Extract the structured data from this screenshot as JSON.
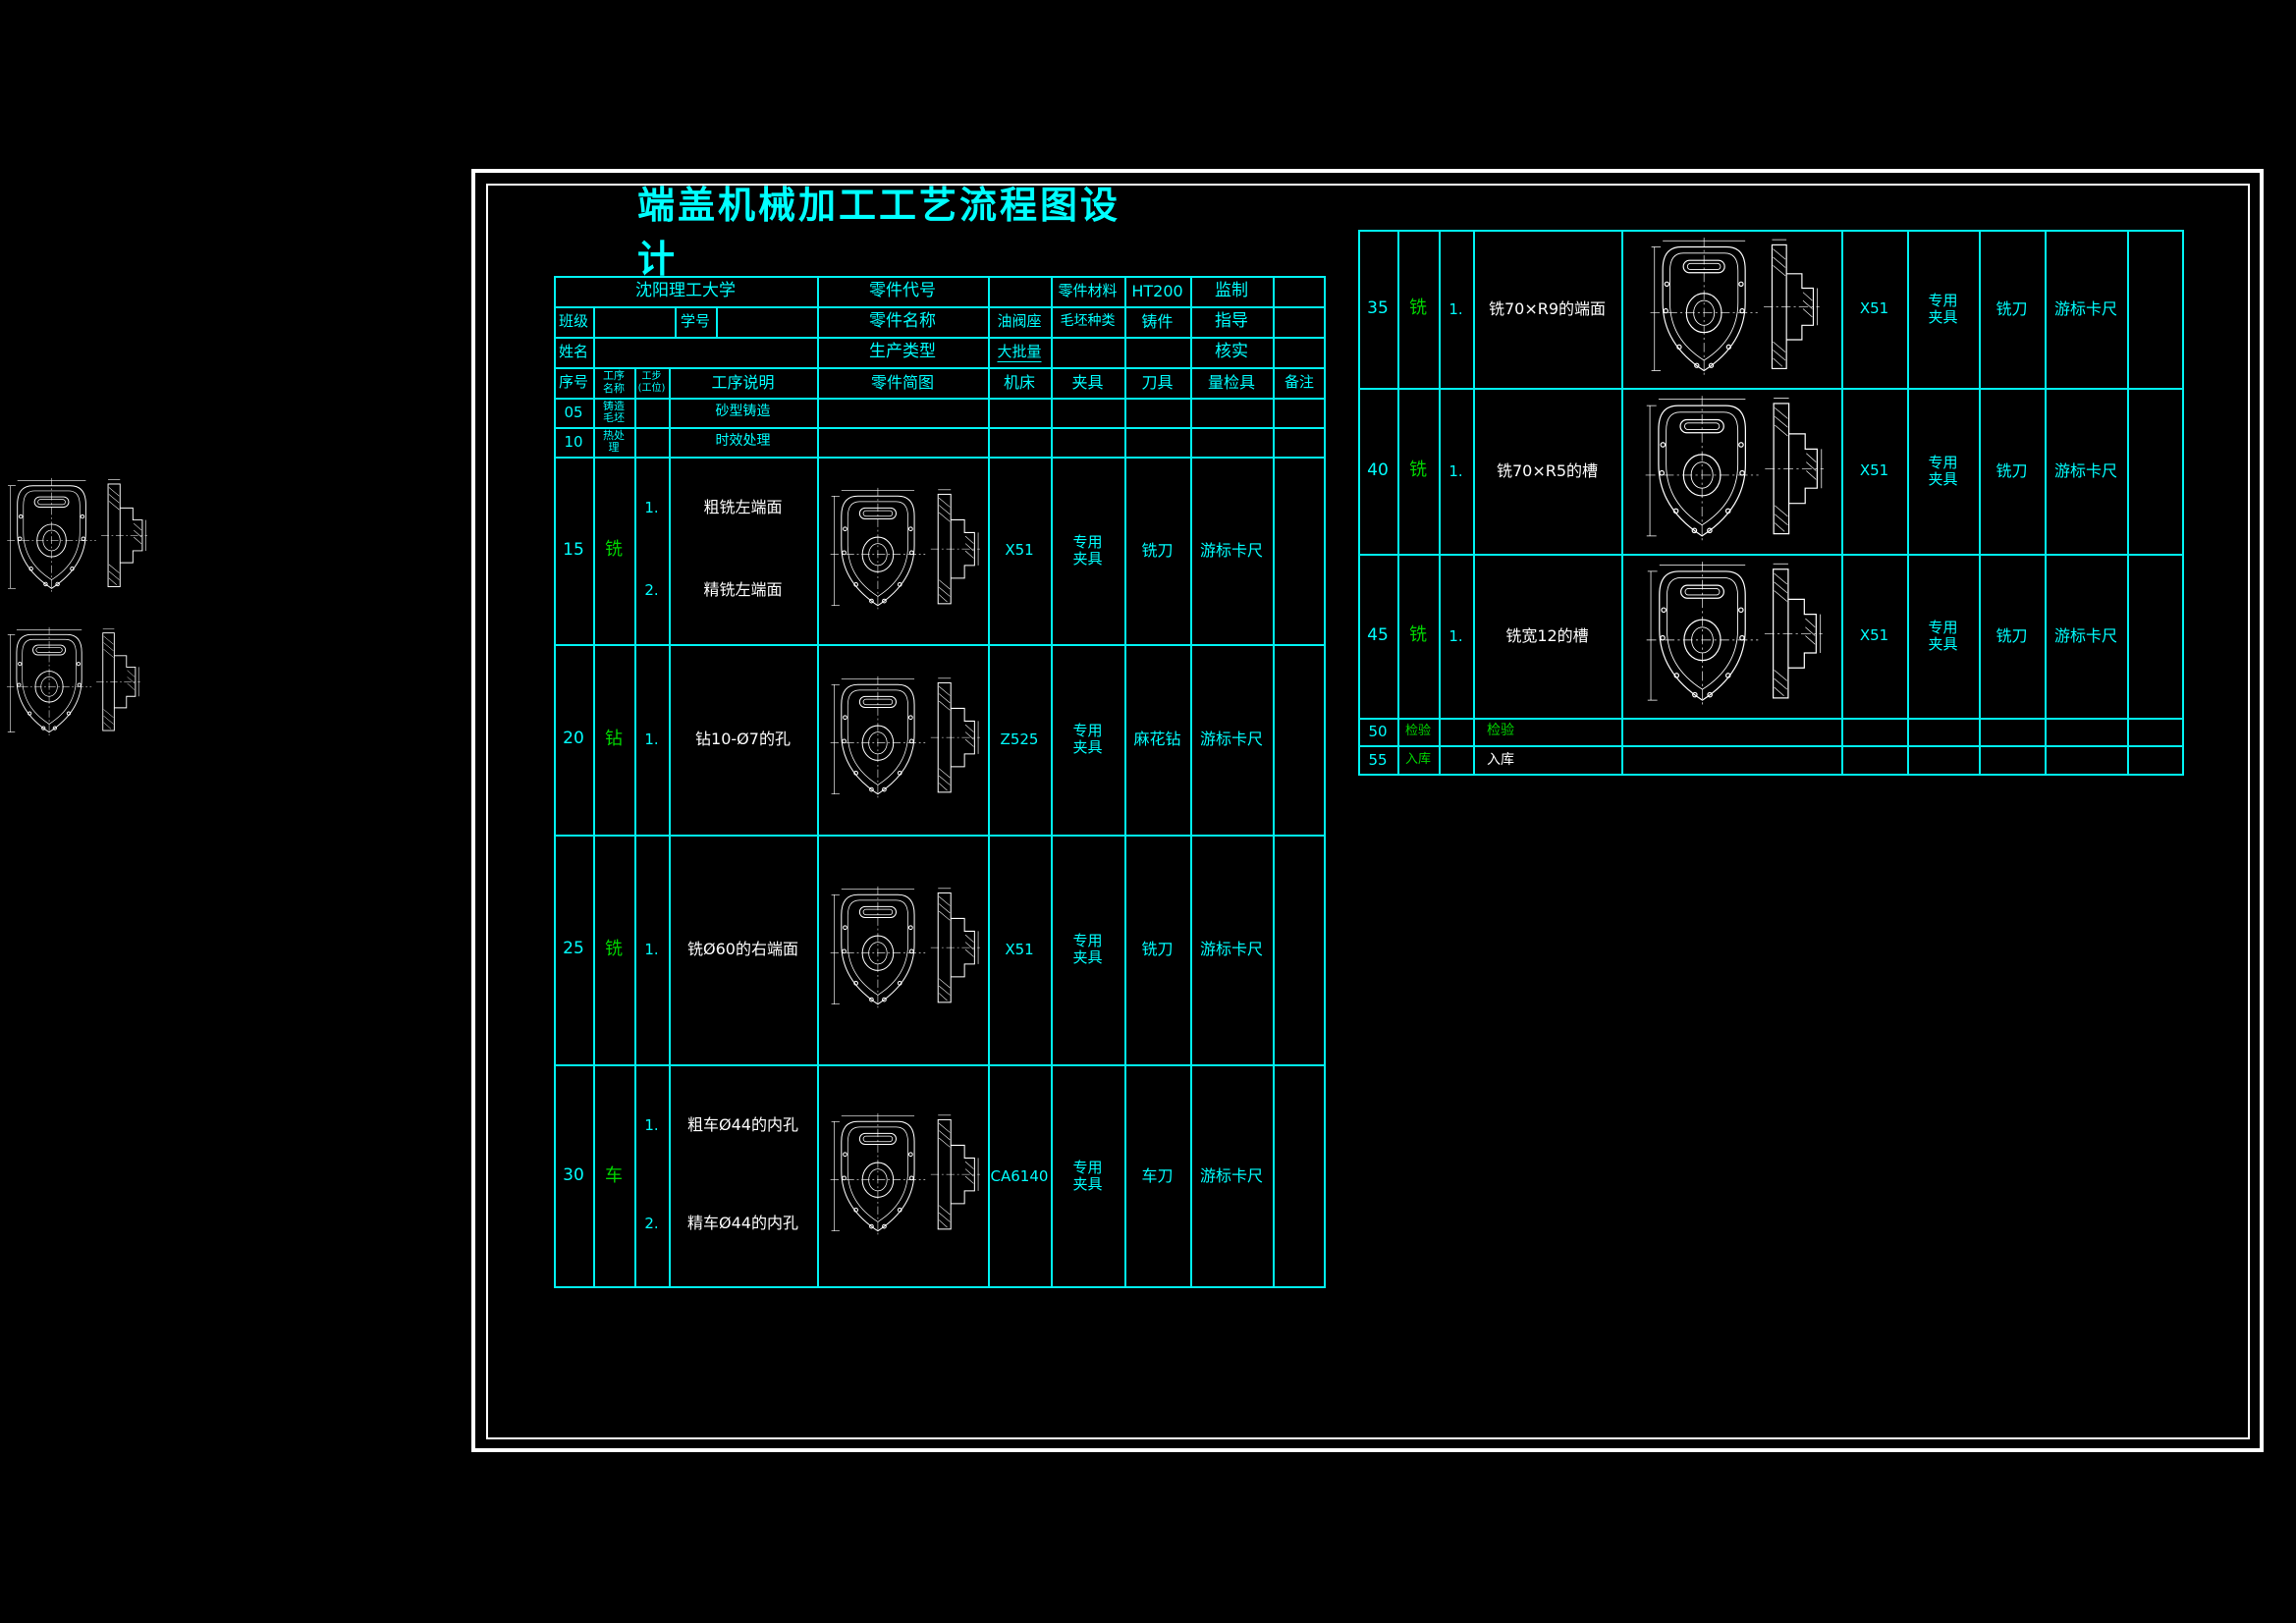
{
  "title": "端盖机械加工工艺流程图设计",
  "colors": {
    "background": "#000000",
    "table_line": "#00f2f2",
    "text_cyan": "#00ffff",
    "text_green": "#00d600",
    "text_white": "#ffffff",
    "frame": "#ffffff"
  },
  "info": {
    "school": "沈阳理工大学",
    "part_code_label": "零件代号",
    "part_material_label": "零件材料",
    "part_material": "HT200",
    "supervise_label": "监制",
    "class_label": "班级",
    "student_id_label": "学号",
    "part_name_label": "零件名称",
    "part_name": "油阀座",
    "blank_type_label": "毛坯种类",
    "blank_type": "铸件",
    "advisor_label": "指导",
    "name_label": "姓名",
    "production_type_label": "生产类型",
    "production_type": "大批量",
    "verify_label": "核实"
  },
  "main_table": {
    "columns": [
      "序号",
      "工序\n名称",
      "工步\n(工位)",
      "工序说明",
      "零件简图",
      "机床",
      "夹具",
      "刀具",
      "量检具",
      "备注"
    ],
    "rows": [
      {
        "no": "05",
        "process": "铸造\n毛坯",
        "proc_color": "cyan",
        "steps": [],
        "descriptions": [
          "砂型铸造"
        ],
        "desc_color": "cyan",
        "machine": "",
        "fixture": "",
        "tool": "",
        "gauge": "",
        "remark": "",
        "sketch": false
      },
      {
        "no": "10",
        "process": "热处\n理",
        "proc_color": "cyan",
        "steps": [],
        "descriptions": [
          "时效处理"
        ],
        "desc_color": "cyan",
        "machine": "",
        "fixture": "",
        "tool": "",
        "gauge": "",
        "remark": "",
        "sketch": false
      },
      {
        "no": "15",
        "process": "铣",
        "proc_color": "green",
        "steps": [
          "1.",
          "2."
        ],
        "descriptions": [
          "粗铣左端面",
          "精铣左端面"
        ],
        "desc_color": "white",
        "machine": "X51",
        "fixture": "专用\n夹具",
        "tool": "铣刀",
        "gauge": "游标卡尺",
        "remark": "",
        "sketch": true
      },
      {
        "no": "20",
        "process": "钻",
        "proc_color": "green",
        "steps": [
          "1."
        ],
        "descriptions": [
          "钻10-Ø7的孔"
        ],
        "desc_color": "white",
        "machine": "Z525",
        "fixture": "专用\n夹具",
        "tool": "麻花钻",
        "gauge": "游标卡尺",
        "remark": "",
        "sketch": true
      },
      {
        "no": "25",
        "process": "铣",
        "proc_color": "green",
        "steps": [
          "1."
        ],
        "descriptions": [
          "铣Ø60的右端面"
        ],
        "desc_color": "white",
        "machine": "X51",
        "fixture": "专用\n夹具",
        "tool": "铣刀",
        "gauge": "游标卡尺",
        "remark": "",
        "sketch": true
      },
      {
        "no": "30",
        "process": "车",
        "proc_color": "green",
        "steps": [
          "1.",
          "2."
        ],
        "descriptions": [
          "粗车Ø44的内孔",
          "精车Ø44的内孔"
        ],
        "desc_color": "white",
        "machine": "CA6140",
        "fixture": "专用\n夹具",
        "tool": "车刀",
        "gauge": "游标卡尺",
        "remark": "",
        "sketch": true
      }
    ]
  },
  "right_table": {
    "rows": [
      {
        "no": "35",
        "process": "铣",
        "proc_color": "green",
        "steps": [
          "1."
        ],
        "descriptions": [
          "铣70×R9的端面"
        ],
        "desc_color": "white",
        "machine": "X51",
        "fixture": "专用\n夹具",
        "tool": "铣刀",
        "gauge": "游标卡尺",
        "remark": "",
        "sketch": true
      },
      {
        "no": "40",
        "process": "铣",
        "proc_color": "green",
        "steps": [
          "1."
        ],
        "descriptions": [
          "铣70×R5的槽"
        ],
        "desc_color": "white",
        "machine": "X51",
        "fixture": "专用\n夹具",
        "tool": "铣刀",
        "gauge": "游标卡尺",
        "remark": "",
        "sketch": true
      },
      {
        "no": "45",
        "process": "铣",
        "proc_color": "green",
        "steps": [
          "1."
        ],
        "descriptions": [
          "铣宽12的槽"
        ],
        "desc_color": "white",
        "machine": "X51",
        "fixture": "专用\n夹具",
        "tool": "铣刀",
        "gauge": "游标卡尺",
        "remark": "",
        "sketch": true
      },
      {
        "no": "50",
        "process": "检验",
        "proc_color": "green",
        "steps": [],
        "descriptions": [
          "检验"
        ],
        "desc_color": "green",
        "machine": "",
        "fixture": "",
        "tool": "",
        "gauge": "",
        "remark": "",
        "sketch": false
      },
      {
        "no": "55",
        "process": "入库",
        "proc_color": "green",
        "steps": [],
        "descriptions": [
          "入库"
        ],
        "desc_color": "white",
        "machine": "",
        "fixture": "",
        "tool": "",
        "gauge": "",
        "remark": "",
        "sketch": false
      }
    ]
  }
}
